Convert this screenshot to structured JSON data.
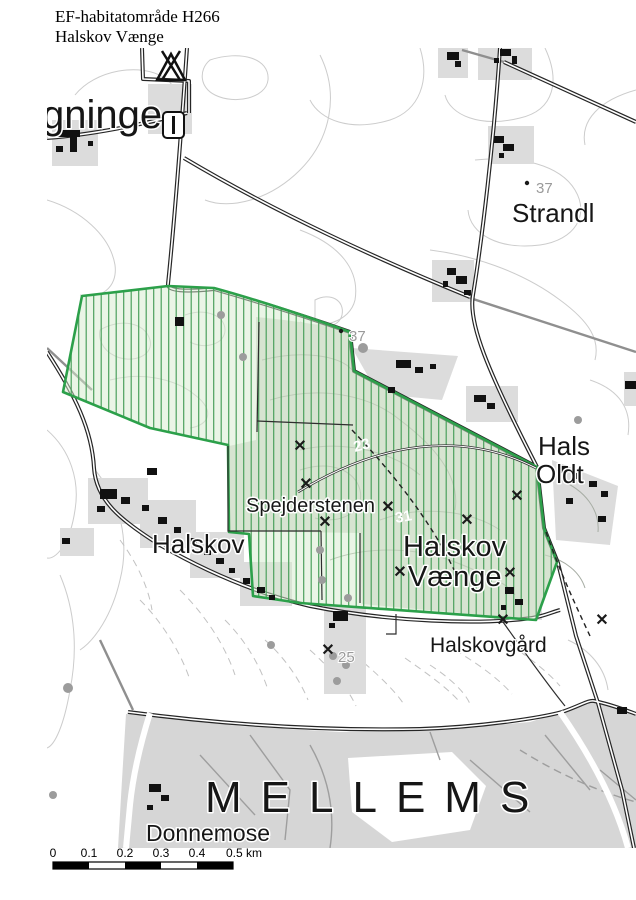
{
  "title": {
    "line1": "EF-habitatområde H266",
    "line2": "Halskov Vænge"
  },
  "map": {
    "labels": {
      "gninge": "gninge",
      "strandl": "Strandl",
      "hals": "Hals",
      "oldt": "Oldt",
      "halskov_village": "Halskov",
      "spejderstenen": "Spejderstenen",
      "halskov_vaenge_line1": "Halskov",
      "halskov_vaenge_line2": "Vænge",
      "halskovgaard": "Halskovgård",
      "mellemskoven": "MELLEMS",
      "donnemose": "Donnemose"
    },
    "spot_heights": {
      "h37_east": "37",
      "h37_mid": "37",
      "h25": "25"
    },
    "contour_labels": {
      "c23": "23",
      "c31": "31"
    },
    "icons": {
      "monument_glyph": "✕",
      "campsite": "tent-icon",
      "waypost": "signpost-icon"
    }
  },
  "scalebar": {
    "ticks": [
      "0",
      "0.1",
      "0.2",
      "0.3",
      "0.4",
      "0.5 km"
    ]
  },
  "colors": {
    "habitat_border": "#2ca04a",
    "habitat_hatch": "#4ba05c",
    "habitat_fill": "rgba(213,236,205,0.50)",
    "contour": "#cccccc",
    "road_casing": "#262626"
  }
}
